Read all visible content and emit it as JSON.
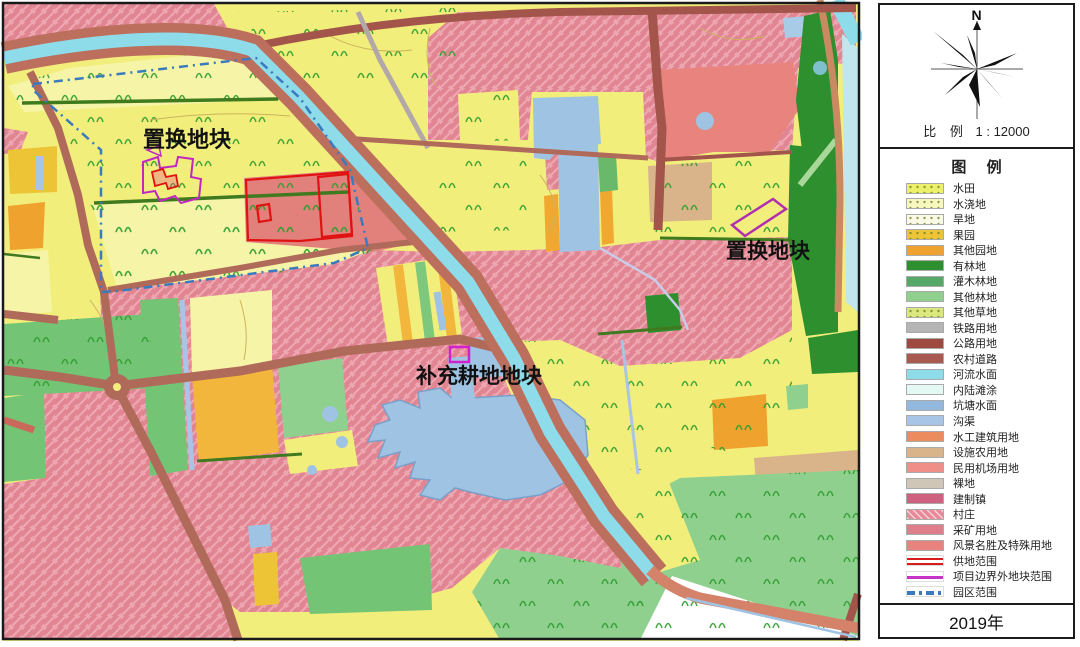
{
  "map": {
    "labels": [
      {
        "text": "置换地块"
      },
      {
        "text": "置换地块"
      },
      {
        "text": "补充耕地地块"
      }
    ]
  },
  "compass": {
    "north": "N"
  },
  "scale": {
    "prefix": "比 例",
    "value": "1 : 12000"
  },
  "legend": {
    "title": "图  例",
    "items": [
      {
        "label": "水田",
        "swatch_style": "background-color:#eef06a"
      },
      {
        "label": "水浇地",
        "swatch_style": "background-color:#f8f7c0"
      },
      {
        "label": "旱地",
        "swatch_style": "background-color:#fbfae6"
      },
      {
        "label": "果园",
        "swatch_style": "background-color:#eec437"
      },
      {
        "label": "其他园地",
        "swatch_style": "background-color:#f0a22e"
      },
      {
        "label": "有林地",
        "swatch_style": "background-color:#2e8f2e"
      },
      {
        "label": "灌木林地",
        "swatch_style": "background-color:#55a868"
      },
      {
        "label": "其他林地",
        "swatch_style": "background-color:#8fd08f"
      },
      {
        "label": "其他草地",
        "swatch_style": "background-color:#dce87d"
      },
      {
        "label": "铁路用地",
        "swatch_style": "background-color:#b5b5b5"
      },
      {
        "label": "公路用地",
        "swatch_style": "background-color:#9e4a40"
      },
      {
        "label": "农村道路",
        "swatch_style": "background-color:#a85a50"
      },
      {
        "label": "河流水面",
        "swatch_style": "background-color:#8edcea"
      },
      {
        "label": "内陆滩涂",
        "swatch_style": "background-color:#e4f8f4"
      },
      {
        "label": "坑塘水面",
        "swatch_style": "background-color:#92b8de"
      },
      {
        "label": "沟渠",
        "swatch_style": "background-color:#a8c4e6"
      },
      {
        "label": "水工建筑用地",
        "swatch_style": "background-color:#ec8c5e"
      },
      {
        "label": "设施农用地",
        "swatch_style": "background-color:#d9b38a"
      },
      {
        "label": "民用机场用地",
        "swatch_style": "background-color:#ef8f88"
      },
      {
        "label": "裸地",
        "swatch_style": "background-color:#cfc6b8"
      },
      {
        "label": "建制镇",
        "swatch_style": "background-color:#d06080"
      },
      {
        "label": "村庄",
        "swatch_style": "background-color:#e8899a"
      },
      {
        "label": "采矿用地",
        "swatch_style": "background-color:#e07f8c"
      },
      {
        "label": "风景名胜及特殊用地",
        "swatch_style": "background-color:#e8847d"
      },
      {
        "label": "供地范围",
        "swatch_style": "background-color:#ffffff"
      },
      {
        "label": "项目边界外地块范围",
        "swatch_style": "background-color:#ffffff"
      },
      {
        "label": "园区范围",
        "swatch_style": "background-color:#ffffff"
      }
    ]
  },
  "year": "2019年",
  "colors": {
    "paddy_field": "#f6f4a6",
    "irrigated_land": "#f2ee7c",
    "village_pink": "#e28593",
    "river_cyan": "#8edcea",
    "pond_blue": "#9fc3e3",
    "road_brown": "#b06a5a",
    "boundary_blue": "#3a7abf",
    "supply_red": "#e01212",
    "external_magenta": "#c028c0"
  }
}
